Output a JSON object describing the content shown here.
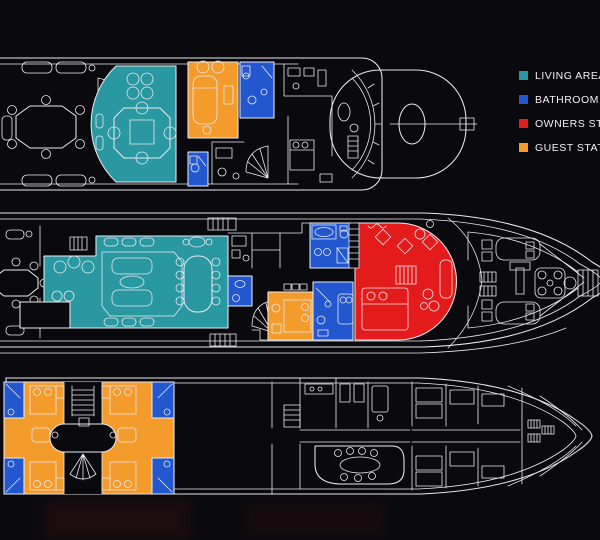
{
  "legend": {
    "items": [
      {
        "id": "living-area",
        "label": "LIVING AREA",
        "color": "#2a98a0"
      },
      {
        "id": "bathroom",
        "label": "BATHROOM",
        "color": "#2257cf"
      },
      {
        "id": "owners-stateroom",
        "label": "OWNERS ST",
        "color": "#e41b1b"
      },
      {
        "id": "guest-stateroom",
        "label": "GUEST STAT",
        "color": "#f39c2b"
      }
    ]
  },
  "colors": {
    "background": "#0a0a0e",
    "line": "#e9e9ef",
    "living_area": "#2a98a0",
    "bathroom": "#2257cf",
    "owners_stateroom": "#e41b1b",
    "guest_stateroom": "#f39c2b"
  }
}
